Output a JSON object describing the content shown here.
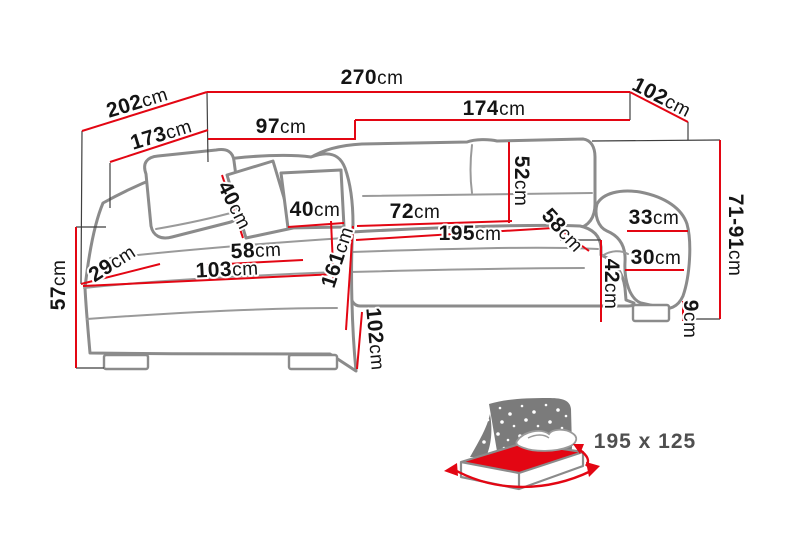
{
  "page": {
    "background": "#ffffff"
  },
  "colors": {
    "dimension_line": "#e30613",
    "sofa_outline": "#8b8b8b",
    "extension_line": "#3f3f3f",
    "label_text": "#141414",
    "icon_gray": "#7b7b7b",
    "icon_label_gray": "#4f4f4f"
  },
  "labels": {
    "total_width": {
      "num": "270",
      "unit": "cm"
    },
    "back_diagonal": {
      "num": "202",
      "unit": "cm"
    },
    "chaise_back": {
      "num": "173",
      "unit": "cm"
    },
    "corner_back": {
      "num": "97",
      "unit": "cm"
    },
    "sofa_back": {
      "num": "174",
      "unit": "cm"
    },
    "depth_top": {
      "num": "102",
      "unit": "cm"
    },
    "height_range": {
      "num": "71-91",
      "unit": "cm"
    },
    "pillow_side": {
      "num": "40",
      "unit": "cm"
    },
    "pillow_front": {
      "num": "40",
      "unit": "cm"
    },
    "backrest_height": {
      "num": "52",
      "unit": "cm"
    },
    "seat_depth": {
      "num": "72",
      "unit": "cm"
    },
    "sleeping_length": {
      "num": "195",
      "unit": "cm"
    },
    "seat_diag_right": {
      "num": "58",
      "unit": "cm"
    },
    "armrest_top": {
      "num": "33",
      "unit": "cm"
    },
    "armrest_inner": {
      "num": "30",
      "unit": "cm"
    },
    "seat_height_right": {
      "num": "42",
      "unit": "cm"
    },
    "leg_height": {
      "num": "9",
      "unit": "cm"
    },
    "seat_height_left": {
      "num": "57",
      "unit": "cm"
    },
    "front_corner": {
      "num": "29",
      "unit": "cm"
    },
    "chaise_seat": {
      "num": "58",
      "unit": "cm"
    },
    "chaise_front": {
      "num": "103",
      "unit": "cm"
    },
    "chaise_length": {
      "num": "161",
      "unit": "cm"
    },
    "depth_bottom": {
      "num": "102",
      "unit": "cm"
    }
  },
  "bed_icon": {
    "size_label": "195 x 125"
  }
}
